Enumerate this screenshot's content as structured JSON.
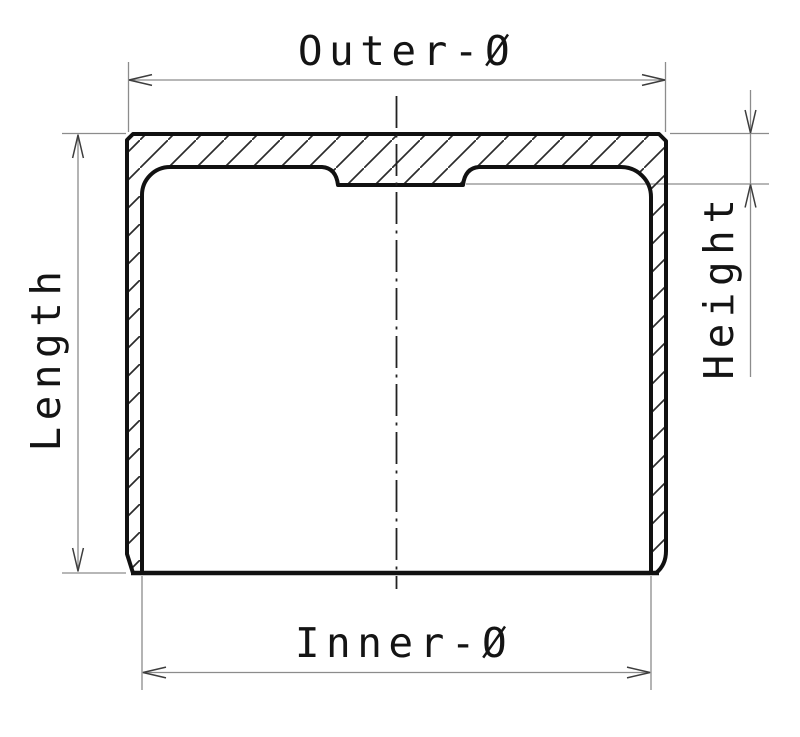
{
  "drawing": {
    "type": "technical-section-drawing",
    "labels": {
      "outer_diameter": "Outer-Ø",
      "inner_diameter": "Inner-Ø",
      "length": "Length",
      "height": "Height"
    },
    "colors": {
      "background": "#ffffff",
      "outline": "#111111",
      "hatch": "#2b2b2b",
      "dimension_line": "#8c8c8c",
      "arrow": "#3d3d3d",
      "text": "#141414"
    }
  }
}
